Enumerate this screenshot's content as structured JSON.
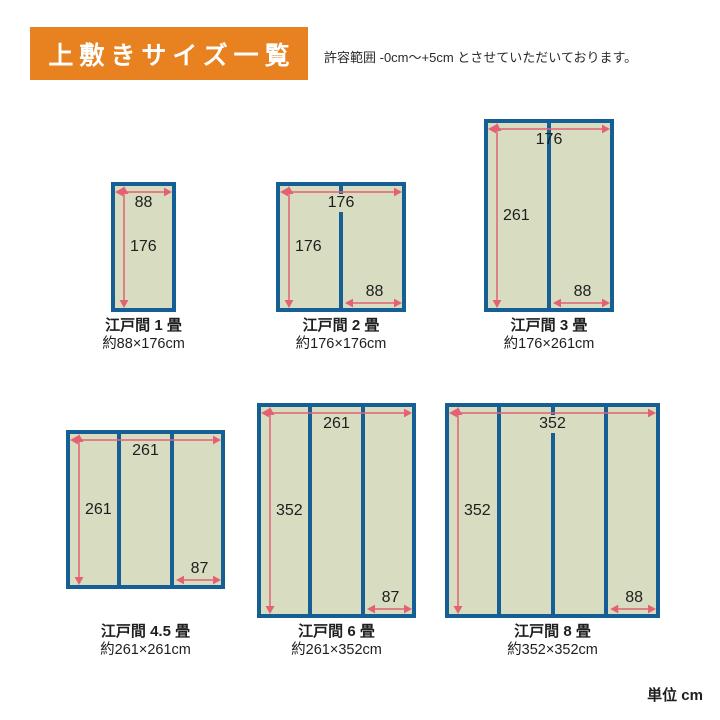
{
  "header": {
    "title": "上敷きサイズ一覧",
    "note": "許容範囲 -0cm〜+5cm とさせていただいております。"
  },
  "footer": {
    "unit": "単位 cm"
  },
  "colors": {
    "banner_orange": "#e8811f",
    "banner_text": "#ffffff",
    "mat_fill": "#d8dcc0",
    "mat_border_blue": "#155f94",
    "arrow_pink": "#e46072",
    "text_dark": "#1e1e1e"
  },
  "diagrams": [
    {
      "name": "江戸間 1 畳",
      "size": "約88×176cm",
      "width_cm": 88,
      "height_cm": 176,
      "panels": 1,
      "width_label": "88",
      "height_label": "176",
      "panel_label": ""
    },
    {
      "name": "江戸間 2 畳",
      "size": "約176×176cm",
      "width_cm": 176,
      "height_cm": 176,
      "panels": 2,
      "width_label": "176",
      "height_label": "176",
      "panel_label": "88"
    },
    {
      "name": "江戸間 3 畳",
      "size": "約176×261cm",
      "width_cm": 176,
      "height_cm": 261,
      "panels": 2,
      "width_label": "176",
      "height_label": "261",
      "panel_label": "88"
    },
    {
      "name": "江戸間 4.5 畳",
      "size": "約261×261cm",
      "width_cm": 261,
      "height_cm": 261,
      "panels": 3,
      "width_label": "261",
      "height_label": "261",
      "panel_label": "87"
    },
    {
      "name": "江戸間 6 畳",
      "size": "約261×352cm",
      "width_cm": 261,
      "height_cm": 352,
      "panels": 3,
      "width_label": "261",
      "height_label": "352",
      "panel_label": "87"
    },
    {
      "name": "江戸間 8 畳",
      "size": "約352×352cm",
      "width_cm": 352,
      "height_cm": 352,
      "panels": 4,
      "width_label": "352",
      "height_label": "352",
      "panel_label": "88"
    }
  ]
}
